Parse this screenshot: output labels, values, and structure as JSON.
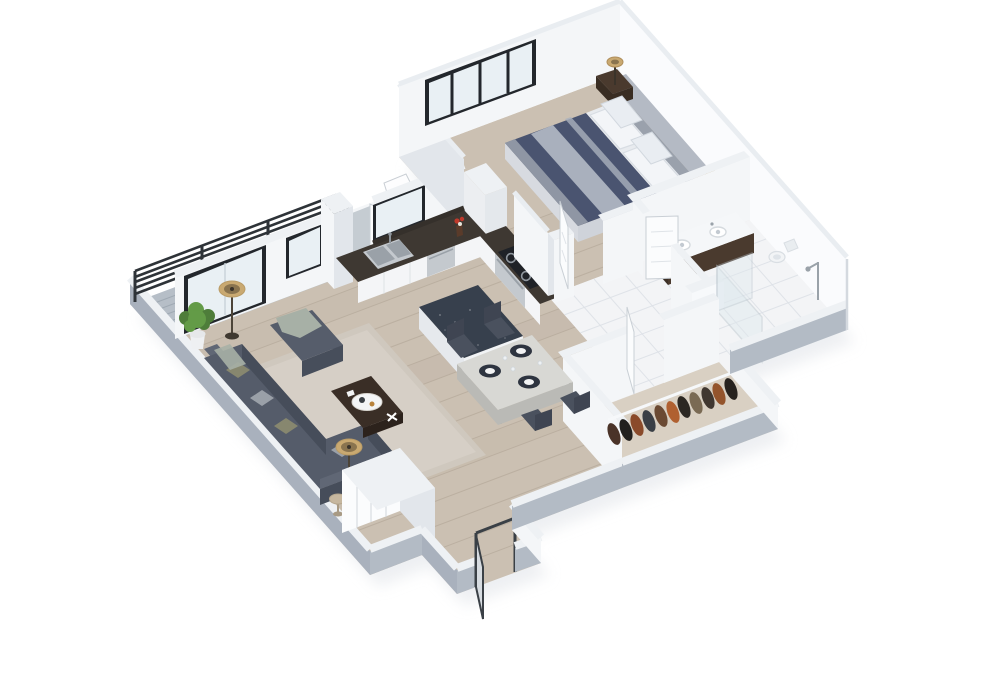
{
  "scene": {
    "type": "3d-isometric-floor-plan",
    "rooms": [
      "living-room",
      "kitchen",
      "dining-area",
      "bedroom",
      "bathroom",
      "walk-in-closet",
      "hallway",
      "balcony",
      "entry"
    ]
  },
  "colors": {
    "background": "#ffffff",
    "shadow": "#e0e3e8",
    "floor_wood": "#cbc0b2",
    "floor_tile": "#f3f4f6",
    "floor_carpet": "#d9d0c3",
    "balcony_deck": "#b6bec7",
    "rug": "#cfc8be",
    "wall_top": "#eef1f4",
    "wall_outer_sw": "#a9b1bd",
    "wall_outer_se": "#b3bbc5",
    "wall_inner": "#f4f6f8",
    "wall_inner_shade": "#e2e6eb",
    "wall_bright": "#fafbfd",
    "frame_black": "#23272c",
    "glass": "#e9f0f4",
    "glass_shower": "#dfe9ee",
    "sofa": "#555c6a",
    "sofa_side": "#464d5a",
    "sofa_back": "#606775",
    "pillow_olive": "#87876f",
    "pillow_gray": "#9aa0a8",
    "throw": "#a7b0a6",
    "ottoman": "#565d6b",
    "ottoman_side": "#474e5b",
    "coffee_table": "#3a2e26",
    "coffee_table_side": "#2c221c",
    "tray": "#f4f5f6",
    "dining_top": "#d8d8d4",
    "dining_side": "#babab6",
    "chair": "#4a515e",
    "placemat": "#2e3440",
    "plate": "#f2f3f4",
    "counter_top": "#3e3832",
    "cabinet": "#f4f5f7",
    "cabinet_shade": "#e4e8ec",
    "steel": "#c4c9ce",
    "steel_dark": "#9aa1a8",
    "stove": "#1f2227",
    "island_top": "#37404d",
    "island_base": "#f1f3f5",
    "island_base_shade": "#e6e9ed",
    "fridge": "#eceef1",
    "bed_navy": "#4a5470",
    "bed_stripe": "#a9b0bd",
    "bed_foot_fold": "#8f96a4",
    "bed_sheet": "#e8ebef",
    "bed_side": "#d7dae0",
    "bed_side2": "#cfd3da",
    "pillow_white": "#f3f5f8",
    "headboard": "#9aa1ac",
    "headboard_top": "#b4bac4",
    "nightstand": "#4a3a2e",
    "nightstand_side": "#392d23",
    "lamp_shade": "#c9a971",
    "lamp_inner": "#8a744f",
    "vanity_top": "#f5f7f9",
    "vanity_wood": "#4a3a2e",
    "vanity_wood_side": "#3d3026",
    "toilet": "#f2f4f6",
    "plant_green": "#4e7d3a",
    "plant_green_light": "#639b47",
    "pot": "#eef0f2",
    "side_table": "#c6b79f",
    "door_white": "#fbfcfd",
    "entry_leaf": "#d7dce1",
    "bistro_white": "#f2f3f5",
    "closet_rail": "#f6f8fa",
    "opening_dark": "#b6bdc6"
  },
  "closet": {
    "clothes_colors": [
      "#4a3328",
      "#22201e",
      "#8a4a2a",
      "#3a3f46",
      "#6b4a33",
      "#b06030",
      "#2c2722",
      "#7a6a54",
      "#403730",
      "#94542c",
      "#27221e"
    ]
  }
}
